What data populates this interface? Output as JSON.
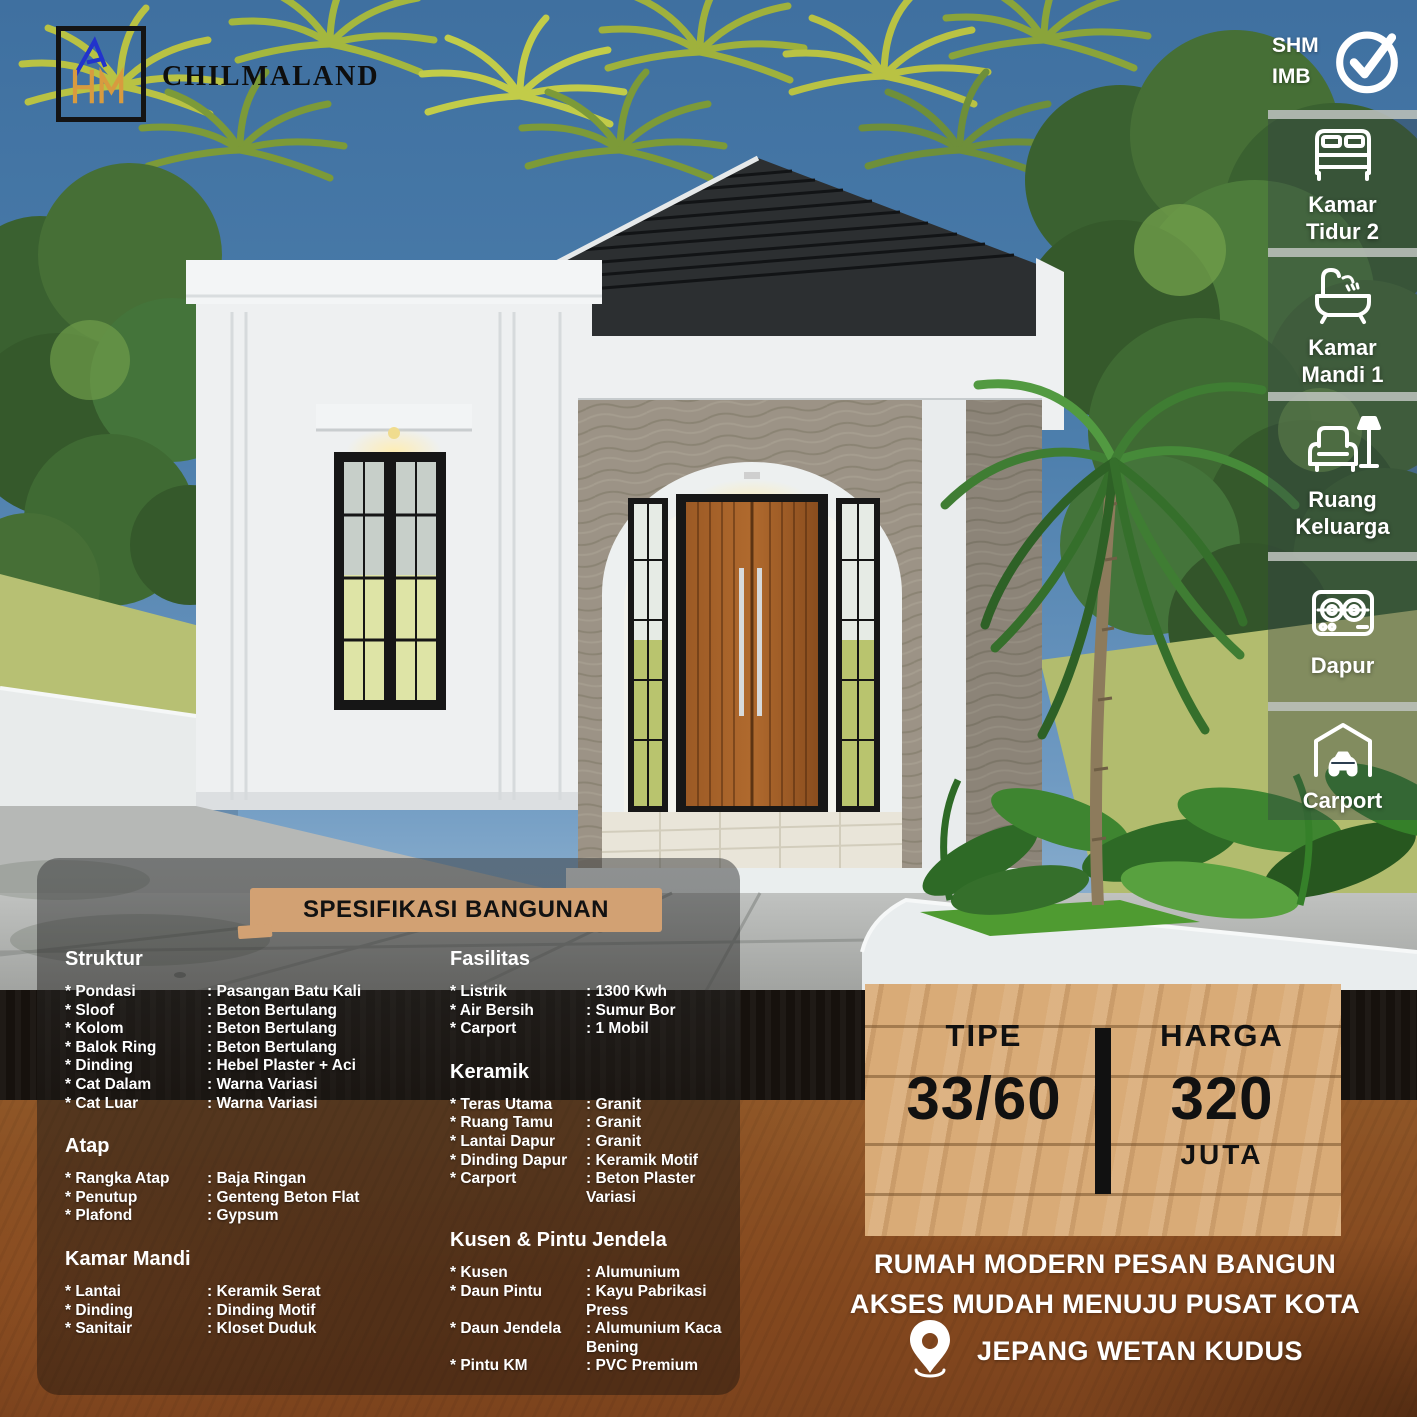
{
  "brand": {
    "name": "CHILMALAND",
    "logo_icon": "chilmaland-monogram-icon"
  },
  "cert": {
    "line1": "SHM",
    "line2": "IMB",
    "icon": "check-icon"
  },
  "sidebar": {
    "items": [
      {
        "icon": "bed-icon",
        "line1": "Kamar",
        "line2": "Tidur 2"
      },
      {
        "icon": "bathtub-icon",
        "line1": "Kamar",
        "line2": "Mandi 1"
      },
      {
        "icon": "sofa-lamp-icon",
        "line1": "Ruang",
        "line2": "Keluarga"
      },
      {
        "icon": "stove-icon",
        "line1": "Dapur",
        "line2": ""
      },
      {
        "icon": "carport-icon",
        "line1": "Carport",
        "line2": ""
      }
    ]
  },
  "specs": {
    "title": "SPESIFIKASI BANGUNAN",
    "bullet": "*",
    "colon": ":",
    "sections": [
      {
        "heading": "Struktur",
        "rows": [
          {
            "label": "Pondasi",
            "value": "Pasangan Batu Kali"
          },
          {
            "label": "Sloof",
            "value": "Beton Bertulang"
          },
          {
            "label": "Kolom",
            "value": "Beton Bertulang"
          },
          {
            "label": "Balok Ring",
            "value": "Beton Bertulang"
          },
          {
            "label": "Dinding",
            "value": "Hebel Plaster + Aci"
          },
          {
            "label": "Cat Dalam",
            "value": "Warna Variasi"
          },
          {
            "label": "Cat Luar",
            "value": "Warna Variasi"
          }
        ]
      },
      {
        "heading": "Atap",
        "rows": [
          {
            "label": "Rangka Atap",
            "value": "Baja Ringan"
          },
          {
            "label": "Penutup",
            "value": "Genteng Beton Flat"
          },
          {
            "label": "Plafond",
            "value": "Gypsum"
          }
        ]
      },
      {
        "heading": "Kamar Mandi",
        "rows": [
          {
            "label": "Lantai",
            "value": "Keramik Serat"
          },
          {
            "label": "Dinding",
            "value": "Dinding Motif"
          },
          {
            "label": "Sanitair",
            "value": "Kloset Duduk"
          }
        ]
      },
      {
        "heading": "Fasilitas",
        "rows": [
          {
            "label": "Listrik",
            "value": "1300 Kwh"
          },
          {
            "label": "Air Bersih",
            "value": "Sumur Bor"
          },
          {
            "label": "Carport",
            "value": "1 Mobil"
          }
        ]
      },
      {
        "heading": "Keramik",
        "rows": [
          {
            "label": "Teras Utama",
            "value": "Granit"
          },
          {
            "label": "Ruang Tamu",
            "value": "Granit"
          },
          {
            "label": "Lantai Dapur",
            "value": "Granit"
          },
          {
            "label": "Dinding Dapur",
            "value": "Keramik Motif"
          },
          {
            "label": "Carport",
            "value": "Beton Plaster Variasi"
          }
        ]
      },
      {
        "heading": "Kusen & Pintu Jendela",
        "rows": [
          {
            "label": "Kusen",
            "value": "Alumunium"
          },
          {
            "label": "Daun Pintu",
            "value": "Kayu Pabrikasi Press"
          },
          {
            "label": "Daun Jendela",
            "value": "Alumunium Kaca Bening"
          },
          {
            "label": "Pintu KM",
            "value": "PVC Premium"
          }
        ]
      }
    ]
  },
  "pricing": {
    "type_label": "TIPE",
    "type_value": "33/60",
    "price_label": "HARGA",
    "price_value": "320",
    "price_unit": "JUTA"
  },
  "tagline": {
    "line1": "RUMAH MODERN PESAN BANGUN",
    "line2": "AKSES MUDAH MENUJU PUSAT KOTA"
  },
  "location": {
    "icon": "pin-icon",
    "name": "JEPANG WETAN KUDUS"
  },
  "colors": {
    "accent_tan": "#d2a173",
    "wood_sign": "#d9ab77",
    "ground_brown": "#8a4e25",
    "sky_blue": "#4b7dab",
    "roof_dark": "#2c2f31",
    "door_wood": "#a05f28"
  }
}
